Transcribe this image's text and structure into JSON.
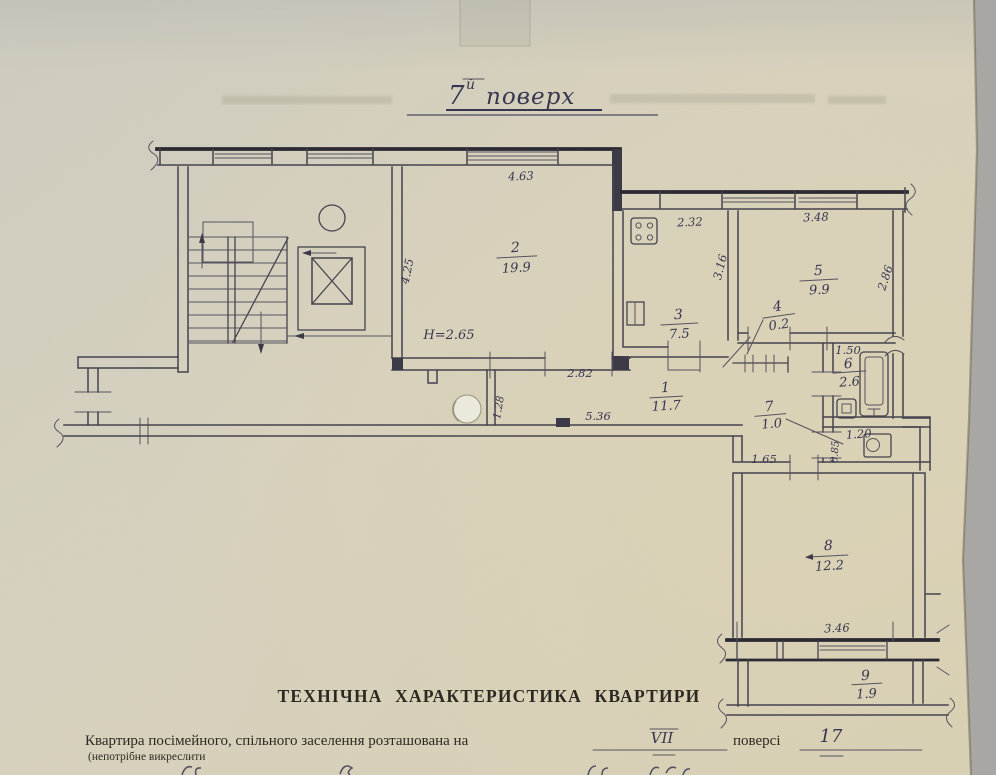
{
  "title": {
    "number": "7",
    "suffix": "й",
    "word": "поверх"
  },
  "rooms": [
    {
      "number": "1",
      "area": "11.7"
    },
    {
      "number": "2",
      "area": "19.9"
    },
    {
      "number": "3",
      "area": "7.5"
    },
    {
      "number": "4",
      "area": "0.2"
    },
    {
      "number": "5",
      "area": "9.9"
    },
    {
      "number": "6",
      "area": "2.6"
    },
    {
      "number": "7",
      "area": "1.0"
    },
    {
      "number": "8",
      "area": "12.2"
    },
    {
      "number": "9",
      "area": "1.9"
    }
  ],
  "dimensions": {
    "room2_width": "4.63",
    "room2_depth": "4.25",
    "ceiling_height": "H=2.65",
    "room2_door_wall": "2.82",
    "kitchen_width": "2.32",
    "kitchen_depth": "3.16",
    "room5_width": "3.48",
    "room5_depth": "2.86",
    "bath_width": "1.50",
    "wc_width": "1.20",
    "wc_depth": "0.85",
    "corridor_length": "5.36",
    "corridor_stub": "1.28",
    "room8_wall": "1.65",
    "balcony_width": "3.46"
  },
  "footer": {
    "heading": "ТЕХНІЧНА ХАРАКТЕРИСТИКА КВАРТИРИ",
    "line": "Квартира посімейного, спільного заселення розташована на",
    "floor_value": "VII",
    "floor_word": "поверсі",
    "storeys_value": "17",
    "note": "(непотрібне викреслити"
  },
  "colors": {
    "paper": "#d6d1bd",
    "background": "#a8a7a3",
    "ink": "#3b3a46"
  }
}
